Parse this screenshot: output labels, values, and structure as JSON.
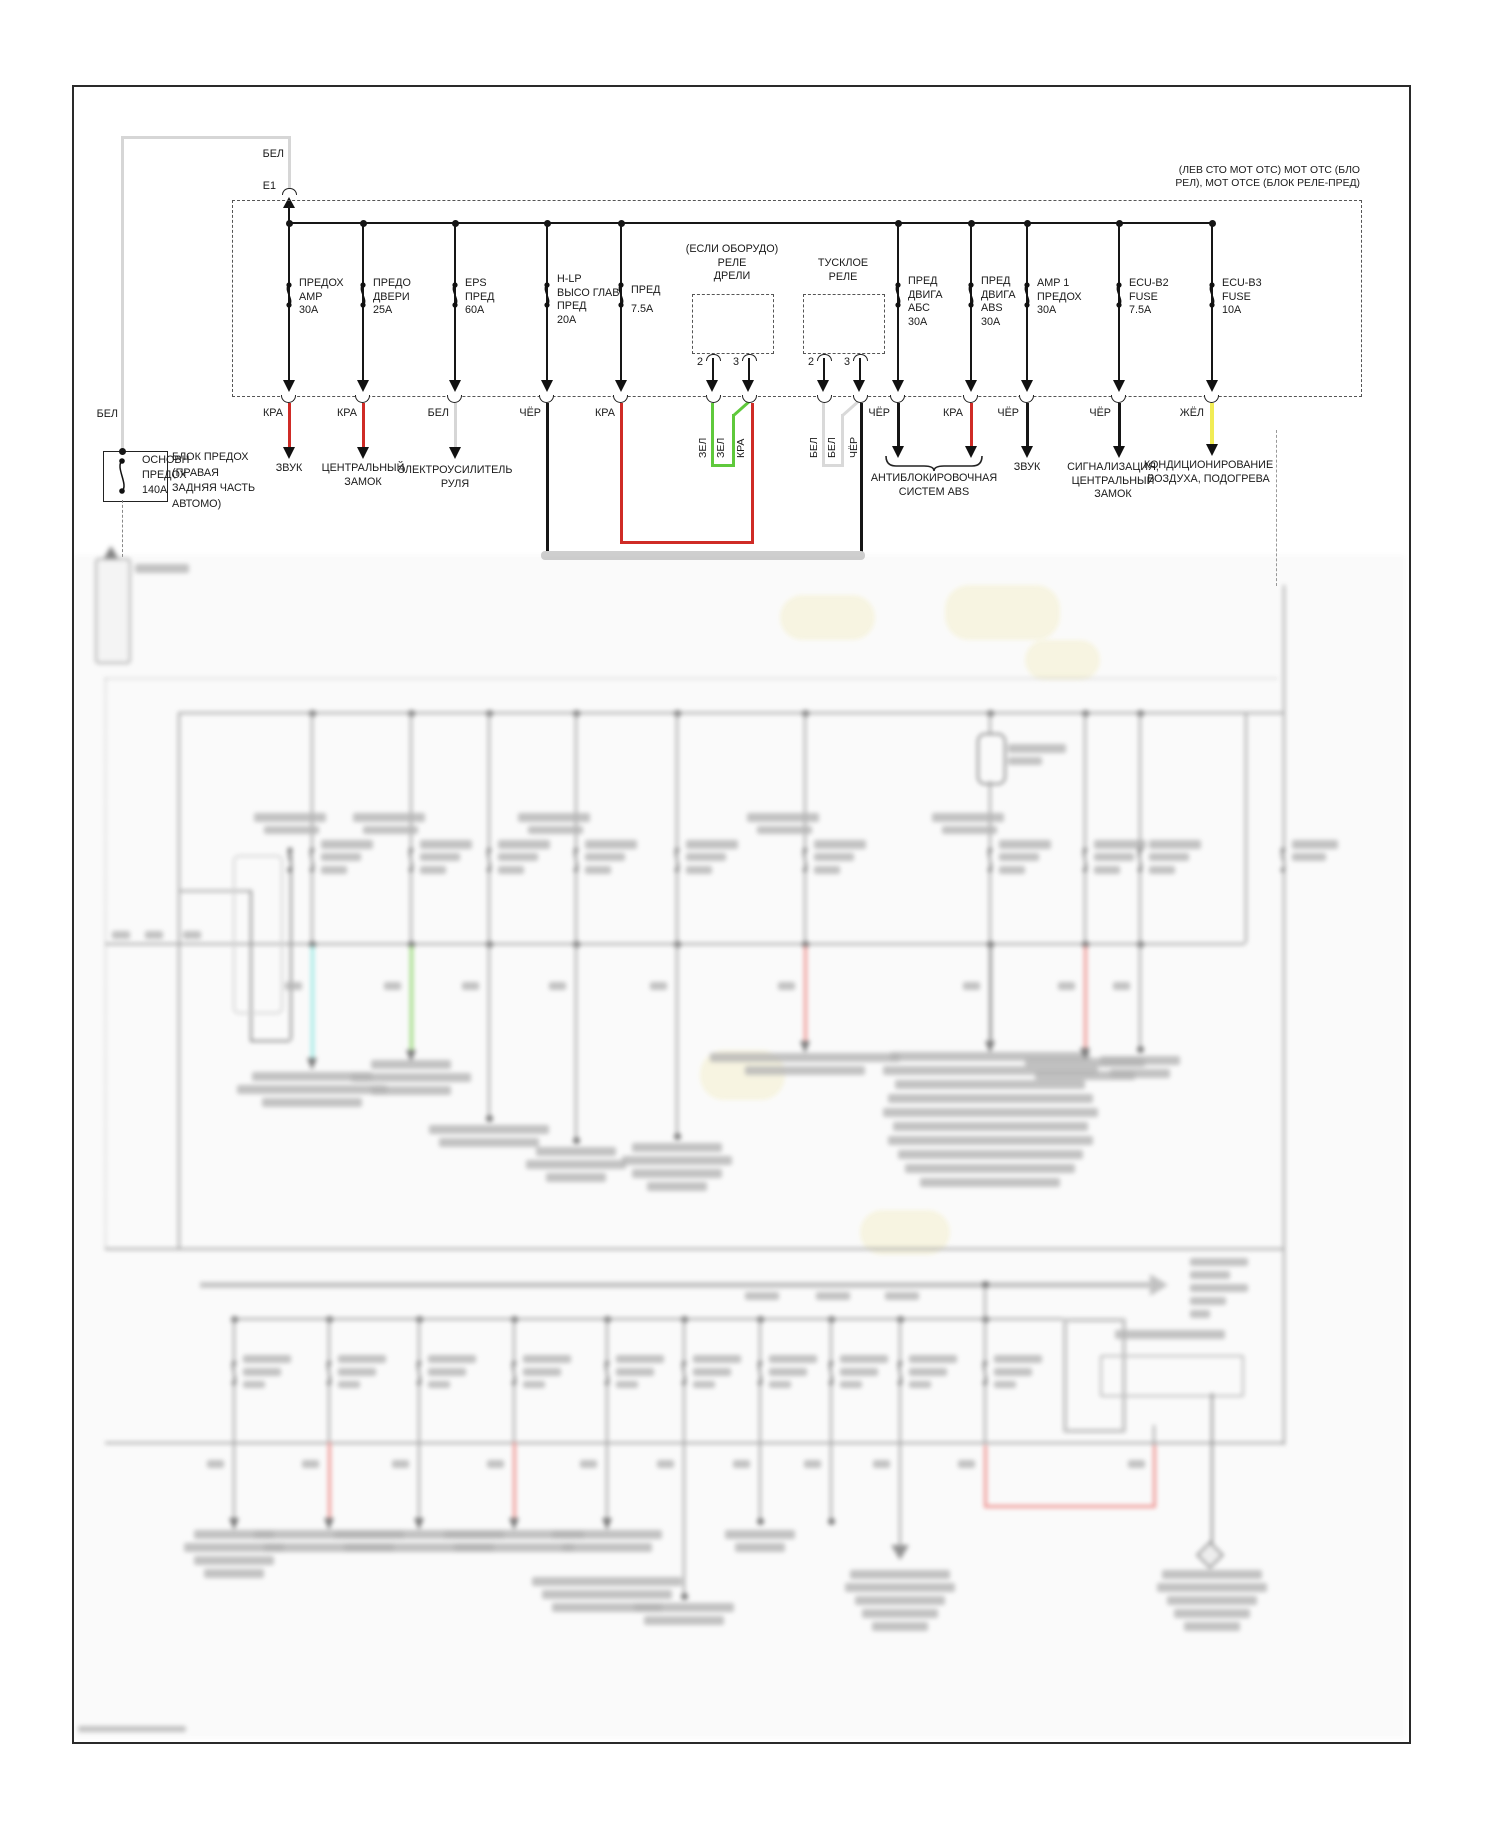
{
  "diagram": {
    "note": "(ЛЕВ СТО МОТ ОТС) МОТ ОТС (БЛО\nРЕЛ), МОТ ОТСЕ (БЛОК РЕЛЕ-ПРЕД)",
    "feed": {
      "wire_color": "БЕЛ",
      "connector": "E1"
    },
    "main_fuse": {
      "label": "ОСНОВН\nПРЕДОХ\n140A",
      "wire_color": "БЕЛ",
      "location": "БЛОК ПРЕДОХ\n(ПРАВАЯ\nЗАДНЯЯ ЧАСТЬ\nАВТОМО)"
    },
    "fuses": [
      {
        "label": "ПРЕДОХ\nAMP\n30A",
        "wire": "КРА",
        "dest": "ЗВУК"
      },
      {
        "label": "ПРЕДО\nДВЕРИ\n25A",
        "wire": "КРА",
        "dest": "ЦЕНТРАЛЬНЫЙ\nЗАМОК"
      },
      {
        "label": "EPS\nПРЕД\n60A",
        "wire": "БЕЛ",
        "dest": "ЭЛЕКТРОУСИЛИТЕЛЬ\nРУЛЯ"
      },
      {
        "label": "H-LP\nВЫСО ГЛАВ\nПРЕД\n20A",
        "wire": "ЧЁР",
        "dest": ""
      },
      {
        "label": "ПРЕД\n7.5A",
        "wire": "КРА",
        "dest": ""
      },
      {
        "label": "ПРЕД\nДВИГА\nАБС\n30A",
        "wire": "ЧЁР",
        "dest": ""
      },
      {
        "label": "ПРЕД\nДВИГА\nABS\n30A",
        "wire": "КРА",
        "dest": ""
      },
      {
        "label": "AMP 1\nПРЕДОХ\n30A",
        "wire": "ЧЁР",
        "dest": "ЗВУК"
      },
      {
        "label": "ECU-B2\nFUSE\n7.5A",
        "wire": "ЧЁР",
        "dest": "СИГНАЛИЗАЦИЯ,\nЦЕНТРАЛЬНЫЙ\nЗАМОК"
      },
      {
        "label": "ECU-B3\nFUSE\n10A",
        "wire": "ЖЁЛ",
        "dest": "КОНДИЦИОНИРОВАНИЕ\nВОЗДУХА, ПОДОГРЕВА"
      }
    ],
    "abs_dest": "АНТИБЛОКИРОВОЧНАЯ\nСИСТЕМ ABS",
    "relays": [
      {
        "title": "(ЕСЛИ ОБОРУДО)\nРЕЛЕ\nДРЕЛИ",
        "pin_a": "2",
        "pin_b": "3",
        "wire_labels": [
          "ЗЕЛ",
          "ЗЕЛ",
          "КРА"
        ]
      },
      {
        "title": "ТУСКЛОЕ\nРЕЛЕ",
        "pin_a": "2",
        "pin_b": "3",
        "wire_labels": [
          "БЕЛ",
          "БЕЛ",
          "ЧЁР"
        ]
      }
    ],
    "wire_colors": {
      "red": "#cf2b26",
      "green": "#5fc93c",
      "yellow": "#f1ec55",
      "white": "#d8d8d8",
      "black": "#1a1a1a"
    },
    "lower_sections": {
      "legible": false,
      "appearance": "out-of-focus continuation of the wiring diagram"
    }
  }
}
